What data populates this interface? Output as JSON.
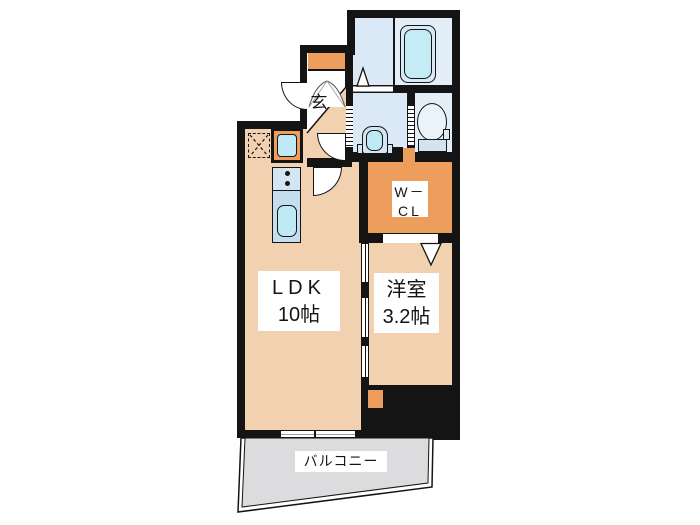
{
  "title": "apartment floor plan",
  "labels": {
    "ldk": {
      "name": "LDK",
      "size": "10帖"
    },
    "western": {
      "name": "洋室",
      "size": "3.2帖"
    },
    "wcl": {
      "line1": "W－",
      "line2": "CL"
    },
    "entrance": {
      "label": "玄"
    },
    "balcony": {
      "label": "バルコニー"
    }
  },
  "fixtures": [
    "bathtub",
    "toilet",
    "washbasin",
    "kitchen-sink",
    "gas-burners",
    "refrigerator-space",
    "washing-machine-space",
    "entry-door",
    "sliding-doors",
    "balcony-windows"
  ],
  "palette": {
    "wall": "#141414",
    "floor": "#f2d1b1",
    "orange": "#ee9e5c",
    "room_blue": "#dbe8f5",
    "room_blue_light": "#e4eef8",
    "cyan": "#c5ecf6",
    "cyan_deep": "#bfe9f4",
    "counter_top": "#d3e5f3",
    "counter_bottom": "#c6ddef",
    "balcony_gray": "#dcdcde"
  }
}
